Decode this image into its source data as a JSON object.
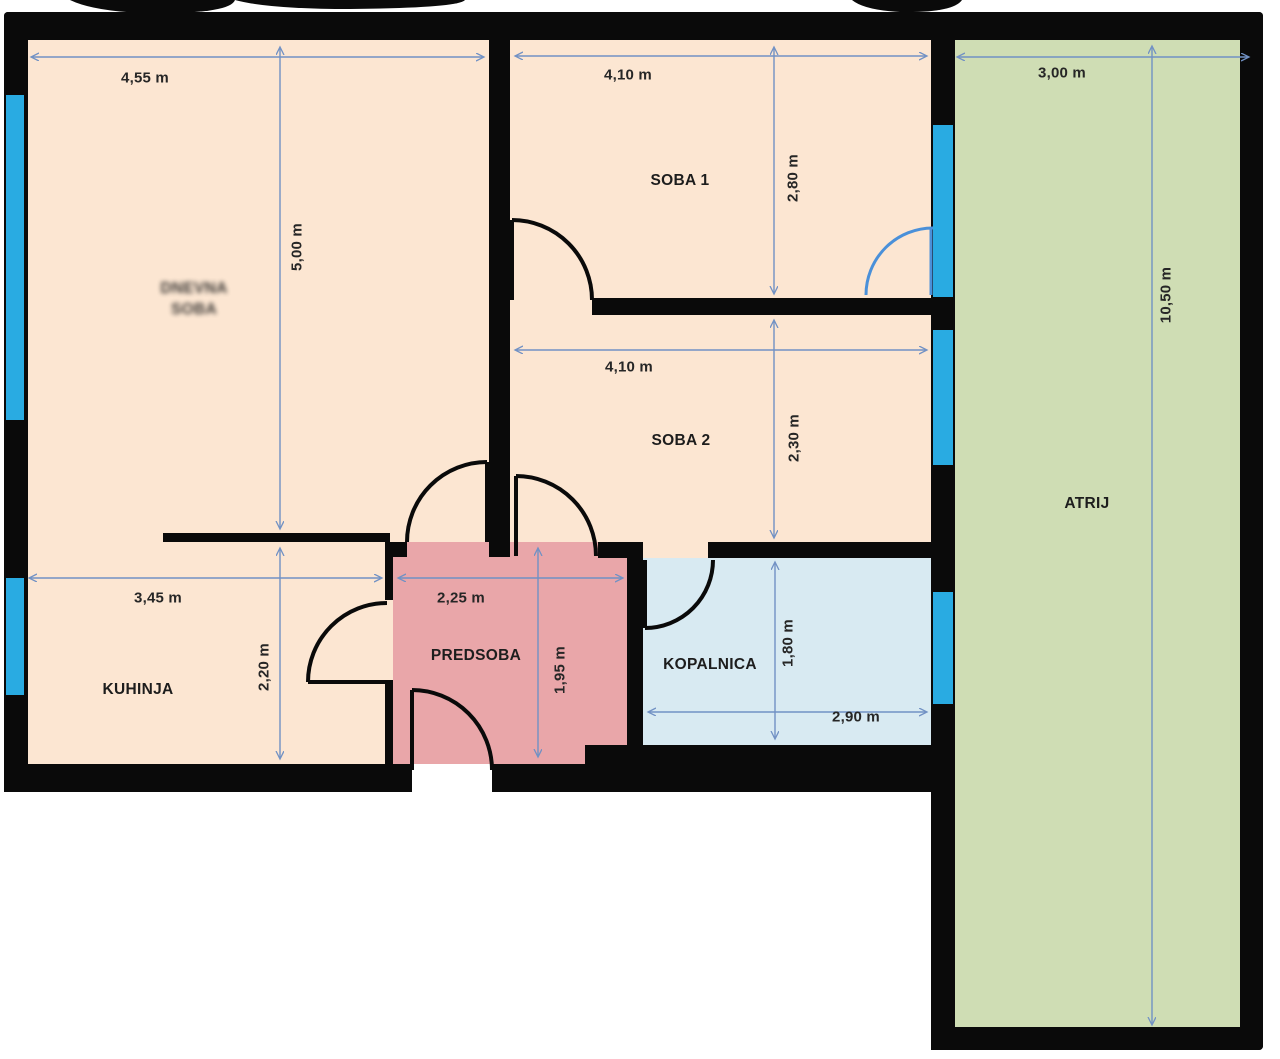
{
  "plan": {
    "type": "floor-plan",
    "rooms": [
      {
        "id": "dnevna-soba",
        "label_line1": "DNEVNA",
        "label_line2": "SOBA",
        "blurred": true,
        "width": "4,55 m",
        "height": "5,00 m"
      },
      {
        "id": "soba-1",
        "label": "SOBA 1",
        "width": "4,10 m",
        "height": "2,80 m"
      },
      {
        "id": "soba-2",
        "label": "SOBA 2",
        "width": "4,10 m",
        "height": "2,30 m"
      },
      {
        "id": "kuhinja",
        "label": "KUHINJA",
        "width": "3,45 m",
        "height": "2,20 m"
      },
      {
        "id": "predsoba",
        "label": "PREDSOBA",
        "width": "2,25 m",
        "height": "1,95 m"
      },
      {
        "id": "kopalnica",
        "label": "KOPALNICA",
        "width": "2,90 m",
        "height": "1,80 m"
      },
      {
        "id": "atrij",
        "label": "ATRIJ",
        "width": "3,00 m",
        "height": "10,50 m"
      }
    ],
    "colors": {
      "room_fill": "#fce6d2",
      "hall_fill": "#e9a6a9",
      "bath_fill": "#d8eaf2",
      "atrium_fill": "#cfddb4",
      "wall": "#0a0a0a",
      "window": "#29abe2",
      "dimension_line": "#7191c4",
      "balcony_door": "#4a90d9"
    }
  }
}
